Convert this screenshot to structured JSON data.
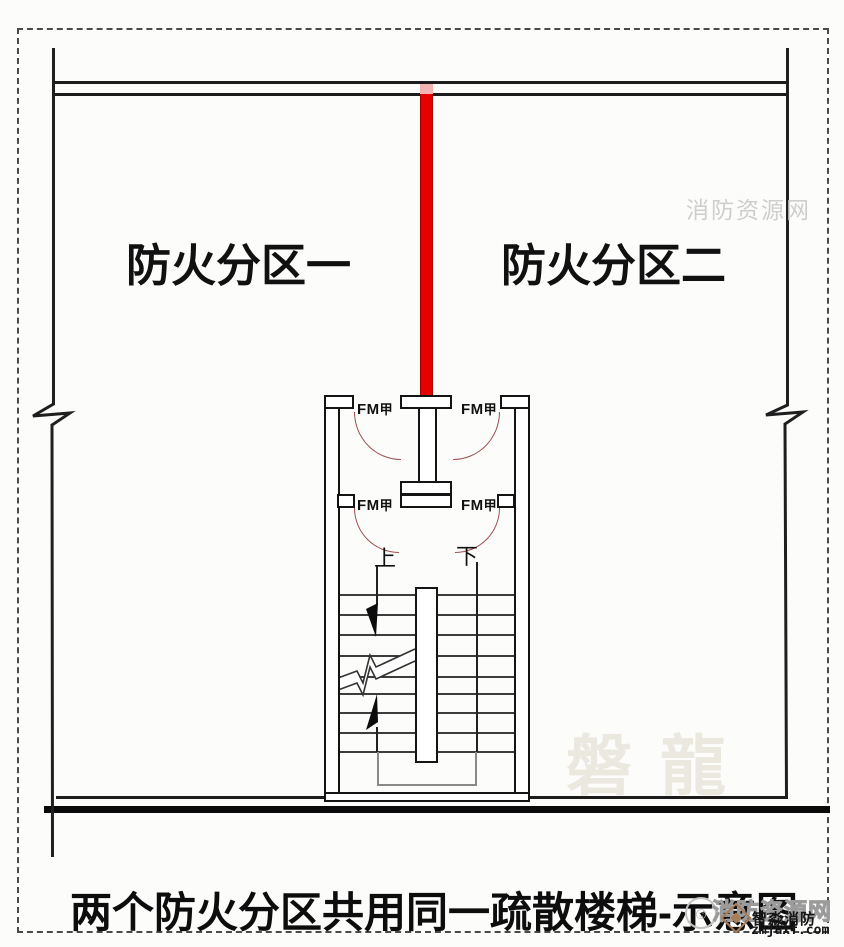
{
  "zones": {
    "zone1": "防火分区一",
    "zone2": "防火分区二"
  },
  "doors": {
    "fm": "FM",
    "jia": "甲"
  },
  "stairs": {
    "up": "上",
    "down": "下"
  },
  "caption": {
    "text": "两个防火分区共用同一疏散楼梯-示意图"
  },
  "watermarks": {
    "top_right": "消防资源网",
    "pan_long": "磐龍",
    "outline": "消防资源网",
    "brand": "智淼消防",
    "site": "zmjaxf.com",
    "smiley": "☺"
  },
  "colors": {
    "fire_wall_red": "#e60000",
    "fire_wall_edge": "#a50000",
    "fire_wall_pink_top": "#f2b3b3",
    "door_arc": "#9c4f4f",
    "drawing_line": "#1a1a1a",
    "landing_gray": "#8a8a8a",
    "watermark_gray": "#c6c6c6",
    "watermark_beige": "#ebe8df",
    "brand_brown": "#a87d5a"
  }
}
